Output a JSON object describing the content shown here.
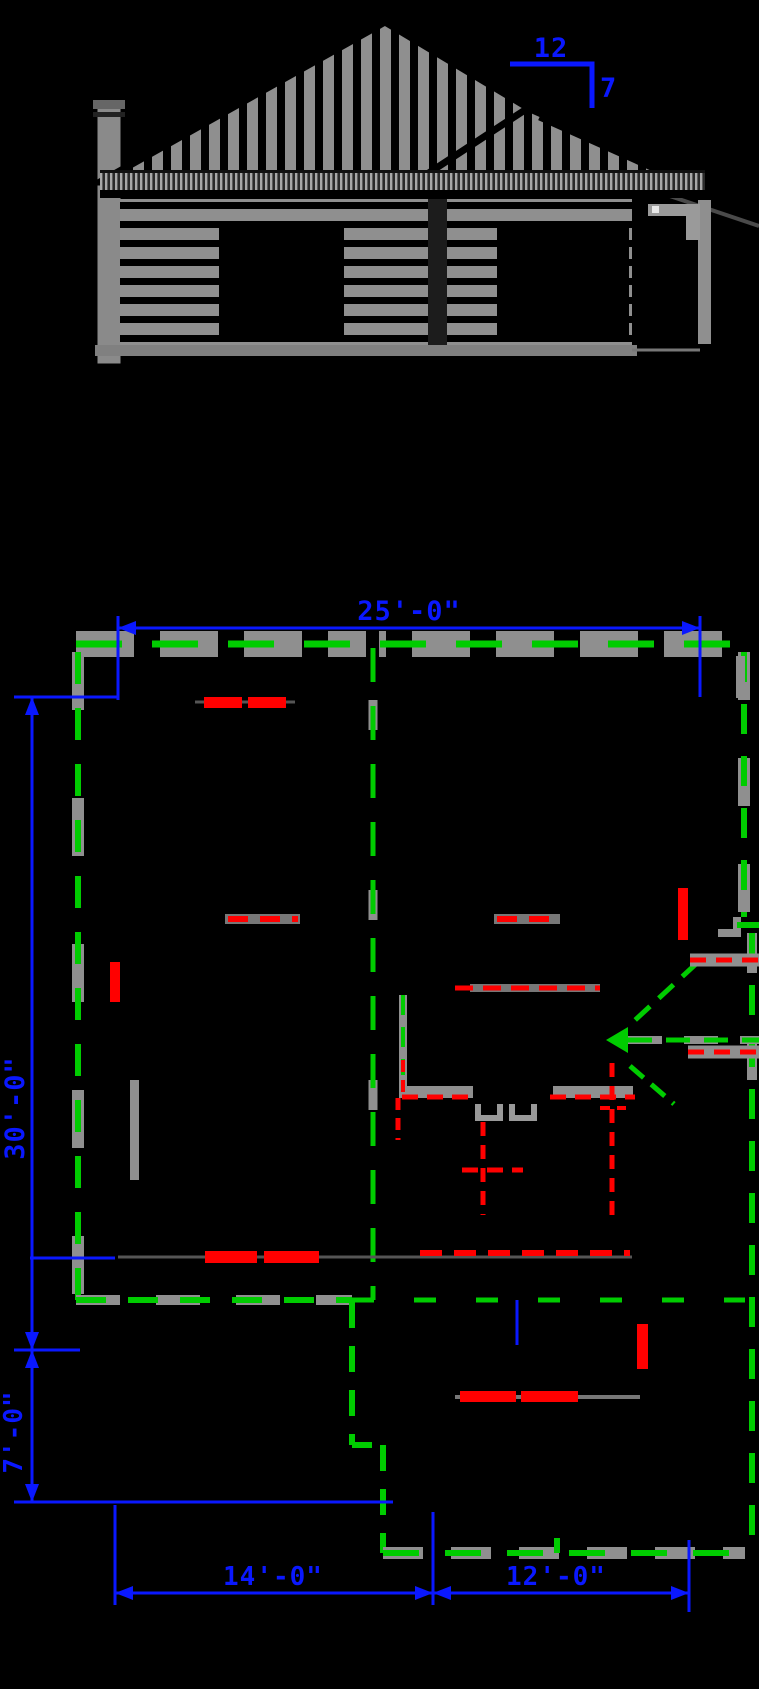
{
  "elevation": {
    "pitch_run": "12",
    "pitch_rise": "7"
  },
  "plan": {
    "dim_top_width": "25'-0\"",
    "dim_left_height": "30'-0\"",
    "dim_left_offset": "7'-0\"",
    "dim_bottom_left": "14'-0\"",
    "dim_bottom_right": "12'-0\""
  },
  "colors": {
    "background": "#000000",
    "dimension_blue": "#0a18ff",
    "roof_outline_green": "#00cc00",
    "demolition_red": "#ff0000",
    "existing_gray": "#8f8f8f"
  }
}
